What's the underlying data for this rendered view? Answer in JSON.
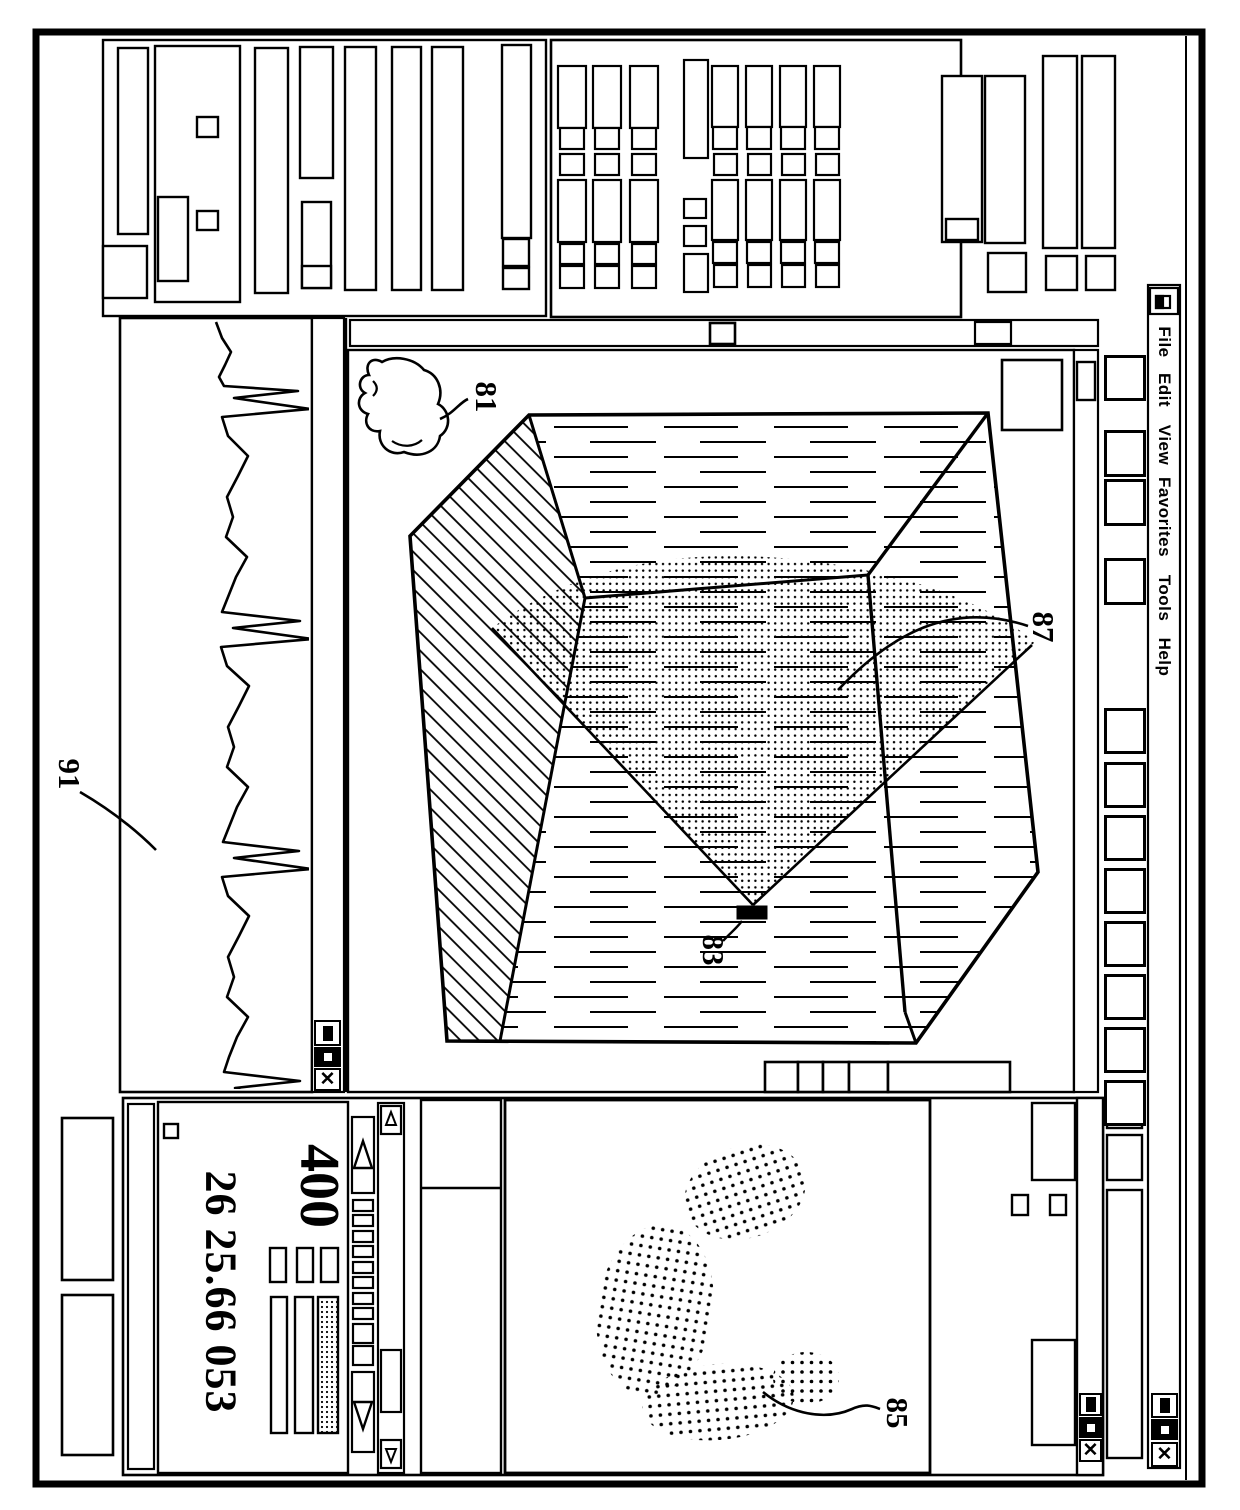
{
  "title_menu": {
    "items": [
      "File",
      "Edit",
      "View",
      "Favorites",
      "Tools",
      "Help"
    ]
  },
  "window_controls": {
    "close_glyph": "✕"
  },
  "readouts": {
    "primary": "400",
    "secondary": "26 25.66 053"
  },
  "figure_labels": {
    "hand_cursor": "81",
    "probe": "83",
    "map_region": "85",
    "scan_surface": "87",
    "ecg_trace": "91"
  },
  "colors": {
    "ink": "#000000",
    "paper": "#ffffff"
  }
}
